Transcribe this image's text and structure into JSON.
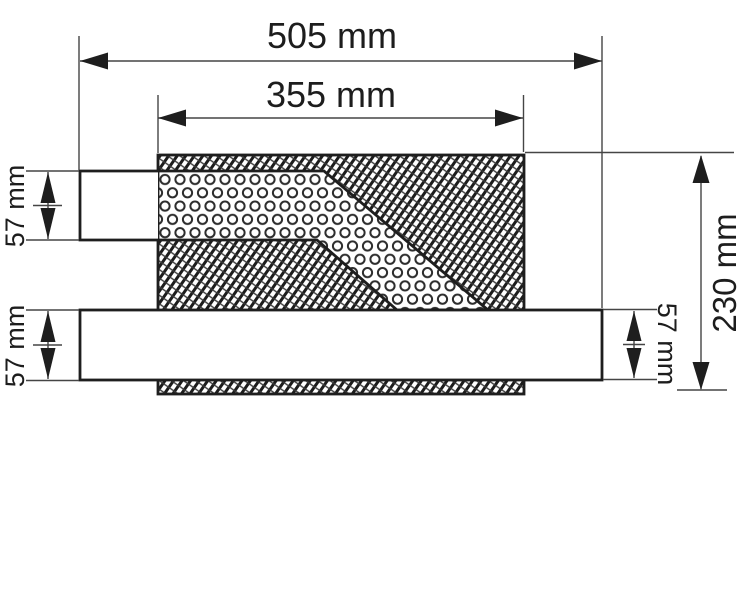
{
  "figure": {
    "background_color": "#ffffff",
    "line_color": "#1e1e1e",
    "dimensions": {
      "overall_length": "505 mm",
      "inner_body_length": "355 mm",
      "inlet_pipe_diameter": "57 mm",
      "outlet_pipe_diameter_left": "57 mm",
      "outlet_pipe_diameter_right": "57 mm",
      "overall_height": "230 mm"
    }
  }
}
